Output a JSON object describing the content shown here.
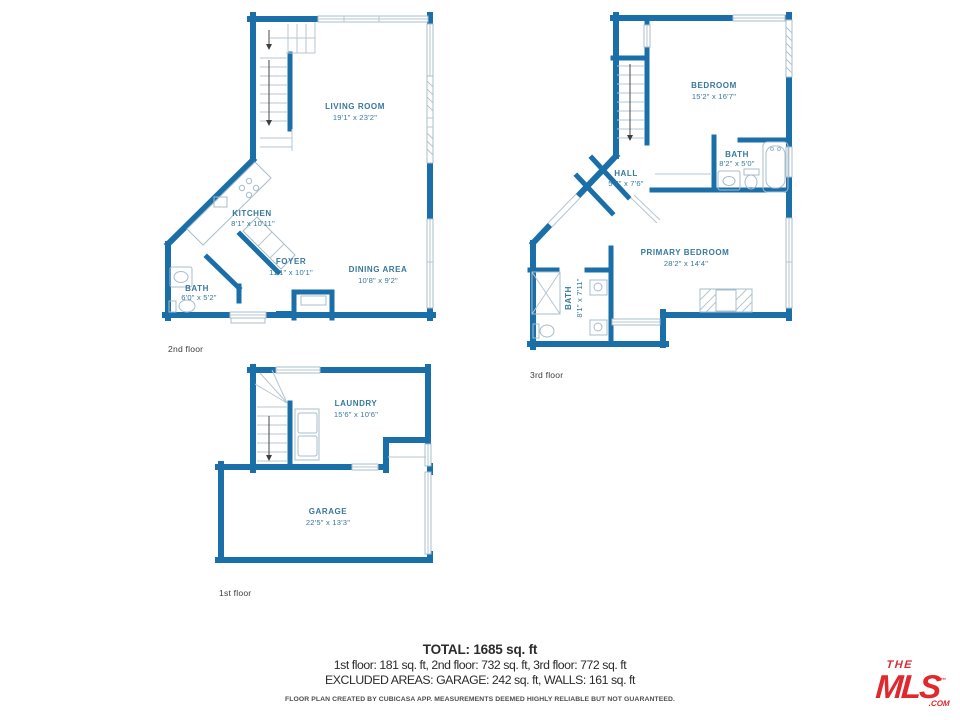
{
  "colors": {
    "wall_blue": "#1a6fa9",
    "room_label_blue": "#36789e",
    "fixture_line_blue": "#a7bccb",
    "logo_red": "#e0282e",
    "summary_text": "#2b2b2b"
  },
  "plans": {
    "second": {
      "floor_label": "2nd floor",
      "rooms": {
        "living_room": {
          "name": "LIVING ROOM",
          "dims": "19'1\" x 23'2\""
        },
        "kitchen": {
          "name": "KITCHEN",
          "dims": "8'1\" x 10'11\""
        },
        "foyer": {
          "name": "FOYER",
          "dims": "11'1\" x 10'1\""
        },
        "dining_area": {
          "name": "DINING AREA",
          "dims": "10'8\" x 9'2\""
        },
        "bath": {
          "name": "BATH",
          "dims": "6'0\" x 5'2\""
        }
      }
    },
    "third": {
      "floor_label": "3rd floor",
      "rooms": {
        "bedroom": {
          "name": "BEDROOM",
          "dims": "15'2\" x 16'7\""
        },
        "bath": {
          "name": "BATH",
          "dims": "8'2\" x 5'0\""
        },
        "hall": {
          "name": "HALL",
          "dims": "5'7\" x 7'6\""
        },
        "primary_bedroom": {
          "name": "PRIMARY BEDROOM",
          "dims": "28'2\" x 14'4\""
        },
        "primary_bath": {
          "name": "BATH",
          "dims": "8'1\" x 7'11\""
        }
      }
    },
    "first": {
      "floor_label": "1st floor",
      "rooms": {
        "laundry": {
          "name": "LAUNDRY",
          "dims": "15'6\" x 10'6\""
        },
        "garage": {
          "name": "GARAGE",
          "dims": "22'5\" x 13'3\""
        }
      }
    }
  },
  "summary": {
    "total": "TOTAL: 1685 sq. ft",
    "floors": "1st floor: 181 sq. ft, 2nd floor: 732 sq. ft, 3rd floor: 772 sq. ft",
    "excluded": "EXCLUDED AREAS: GARAGE: 242 sq. ft, WALLS: 161 sq. ft",
    "disclaimer": "FLOOR PLAN CREATED BY CUBICASA APP. MEASUREMENTS DEEMED HIGHLY RELIABLE BUT NOT GUARANTEED."
  },
  "logo": {
    "the": "THE",
    "mls": "MLS",
    "tm": "™",
    "com": ".COM"
  }
}
